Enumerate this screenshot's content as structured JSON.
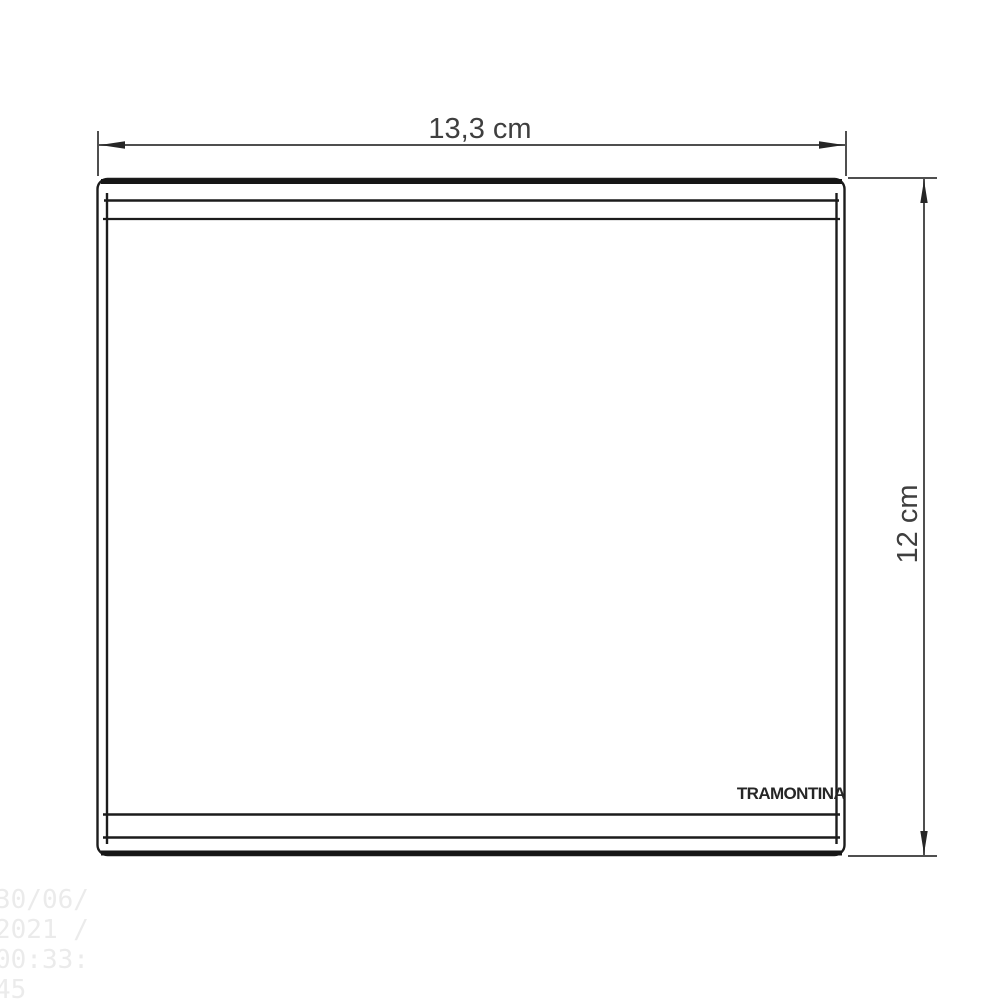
{
  "diagram": {
    "width_dimension": {
      "label": "13,3 cm"
    },
    "height_dimension": {
      "label": "12 cm"
    },
    "brand_logo": "TRAMONTINA",
    "watermark": {
      "lines": [
        "30/06/",
        "2021 /",
        "00:33:",
        "45"
      ]
    },
    "colors": {
      "drawing_line": "#1c1c1c",
      "dimension_line": "#4f4f4f",
      "dimension_text": "#3f3f3f",
      "logo_text": "#262626",
      "watermark_text": "#ebebeb",
      "background": "#ffffff"
    }
  }
}
